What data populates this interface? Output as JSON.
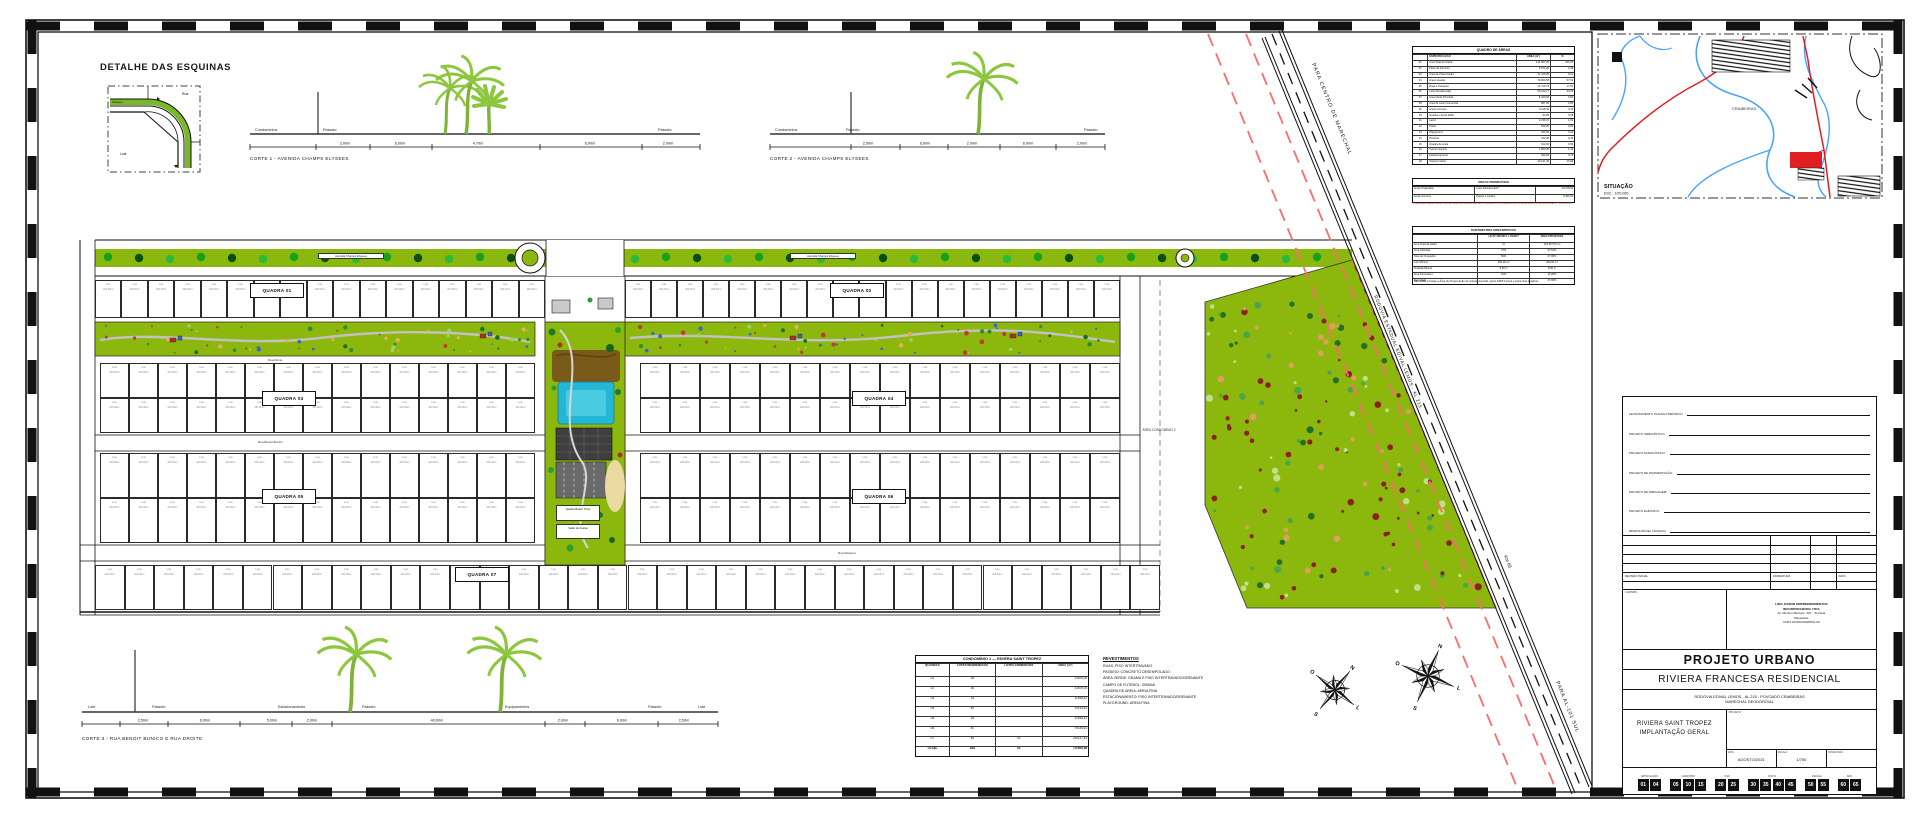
{
  "corner_detail": {
    "title": "DETALHE DAS ESQUINAS",
    "rua": "Rua",
    "passeio": "Passeio",
    "lote": "Lote",
    "dim1": "3,00",
    "dim2": "3,00"
  },
  "cortes": [
    {
      "caption": "CORTE 1 - AVENIDA CHAMPS ELYSEES",
      "labels": [
        "Condomínios",
        "Passeio",
        "Passeio"
      ],
      "dims": [
        "2,00m",
        "6,00m",
        "4,70m",
        "6,00m",
        "2,00m"
      ]
    },
    {
      "caption": "CORTE 2 - AVENIDA CHAMPS ELYSEES",
      "labels": [
        "Condomínios",
        "Passeio",
        "Passeio"
      ],
      "dims": [
        "2,50m",
        "6,00m",
        "2,00m",
        "6,00m",
        "2,00m"
      ]
    },
    {
      "caption": "CORTE 3 - RUA BENOIT BUNICO E RUA DROITE",
      "labels": [
        "Lote",
        "Passeio",
        "Estacionamento",
        "Passeio",
        "Equipamentos",
        "Passeio",
        "Lote"
      ],
      "dims": [
        "2,50m",
        "6,00m",
        "5,00m",
        "2,00m",
        "40,00m",
        "2,00m",
        "6,00m",
        "2,50m"
      ]
    }
  ],
  "plan": {
    "avenue_label": "Avenida Champs Elysees",
    "street_droite": "Rua Droite",
    "street_benoit": "Rua Benoit Bunico",
    "street_messina": "Rua Messina",
    "quadras": [
      "QUADRA 01",
      "QUADRA 02",
      "QUADRA 03",
      "QUADRA 04",
      "QUADRA 05",
      "QUADRA 06",
      "QUADRA 07"
    ],
    "area2_label": "ÁREA CONDOMÍNIO 2",
    "lot_label": "Lote",
    "lot_area": "200,00m²",
    "central_labels": [
      "Quadra Beach Tênis",
      "Salão de Festas"
    ],
    "road": {
      "name": "RODOVIA ESTADUAL EDIVAL LEMOS - AL 215",
      "km": "Km 65",
      "to_north": "PARA CENTRO DE MARECHAL",
      "to_south": "PARA AL-101 SUL"
    }
  },
  "quadro_areas": {
    "title": "QUADRO DE ÁREAS",
    "columns": [
      "",
      "ESPECIFICAÇÃO",
      "ÁREA (m²)",
      "%"
    ],
    "rows": [
      [
        "01",
        "Área Total da Gleba",
        "123.367,00",
        "100,00"
      ],
      [
        "02",
        "Faixa de Domínio",
        "3.071,20",
        "2,49"
      ],
      [
        "03",
        "Área de Preservação",
        "11.116,05",
        "9,01"
      ],
      [
        "04",
        "Área Loteada",
        "70.960,58",
        "57,52"
      ],
      [
        "05",
        "Ruas e Passeios",
        "21.710,75",
        "17,60"
      ],
      [
        "06",
        "Lotes Residenciais",
        "50.122,77",
        "40,63"
      ],
      [
        "07",
        "Área Verde Principal",
        "8.420,00",
        "6,82"
      ],
      [
        "08",
        "Área de Lazer Comercial",
        "987,00",
        "0,80"
      ],
      [
        "09",
        "Áreas Comuns",
        "5.118,42",
        "4,15"
      ],
      [
        "10",
        "Guarita e Apoio ADM",
        "94,05",
        "0,08"
      ],
      [
        "11",
        "Lazer",
        "2.236,70",
        "1,81"
      ],
      [
        "12",
        "Clube",
        "812,00",
        "0,66"
      ],
      [
        "13",
        "Playground",
        "420,00",
        "0,34"
      ],
      [
        "14",
        "Piscinas",
        "312,00",
        "0,25"
      ],
      [
        "15",
        "Quadra de Areia",
        "612,00",
        "0,50"
      ],
      [
        "16",
        "Campo Society",
        "1.800,00",
        "1,46"
      ],
      [
        "17",
        "Estacionamento",
        "940,00",
        "0,76"
      ],
      [
        "18",
        "Sistema Viário",
        "13.191,49",
        "10,69"
      ]
    ]
  },
  "permeaveis": {
    "title": "ÁREAS PERMEÁVEIS",
    "rows": [
      [
        "Áreas Projetadas",
        "Lotes Residenciais*",
        "44.278,00"
      ],
      [
        "Áreas Comuns",
        "Praças e Jardins",
        "8.420,00"
      ]
    ],
    "note": "* A área permeável específica de cada lote deverá atender o disposto no Zoneamento e Ordenamento de Lei Municipal N° 1.028/2017."
  },
  "parametros": {
    "title": "PARÂMETROS URBANÍSTICOS",
    "columns": [
      "",
      "LEI Nº 295/2017 e 10/2017",
      "ÁREA PROJETADA"
    ],
    "rows": [
      [
        "Área Total da Gleba",
        "m²",
        "123.367,00 m²"
      ],
      [
        "Área Utilizada",
        "70%",
        "57,52%"
      ],
      [
        "Taxa de Ocupação",
        "60%",
        "47,00%"
      ],
      [
        "Lote Mínimo",
        "200,00 m²",
        "200,00 m²"
      ],
      [
        "Testada Mínima",
        "8,00 m",
        "8,00 m"
      ],
      [
        "Área Permeável",
        "10%",
        "11,05%"
      ],
      [
        "Densidade",
        "—",
        "47,00%"
      ]
    ],
    "note": "* Não estão inclusas a Área de Preservação de Coleta, Avenida, Apoio ADM, Lixeira e Apoio das Quadras."
  },
  "condominio_table": {
    "title": "CONDOMÍNIO 1 — RIVIERA SAINT TROPEZ",
    "columns": [
      "QUADRAS",
      "LOTES RESIDENCIAIS",
      "LOTES COMERCIAIS",
      "ÁREA (m²)"
    ],
    "rows": [
      [
        "01",
        "30",
        "",
        "4.800,00"
      ],
      [
        "02",
        "30",
        "",
        "4.800,00"
      ],
      [
        "03",
        "34",
        "",
        "6.468,42"
      ],
      [
        "04",
        "40",
        "",
        "9.634,61"
      ],
      [
        "05",
        "34",
        "",
        "6.468,42"
      ],
      [
        "06",
        "40",
        "",
        "9.634,61"
      ],
      [
        "07",
        "45",
        "01",
        "26.637,81"
      ],
      [
        "TOTAL",
        "253",
        "01",
        "70.960,58"
      ]
    ]
  },
  "notes": {
    "title": "REVESTIMENTOS",
    "lines": [
      "RUAS: PISO INTERTRAVADO",
      "PASSEIO: CONCRETO DESEMPOLADO",
      "ÁREA VERDE: GRAMA E PISO INTERTRAVADO/DRENANTE",
      "CAMPO DE FUTEBOL: GRAMA",
      "QUADRA DE AREIA: AREIA FINA",
      "ESTACIONAMENTO: PISO INTERTRAVADO/DRENANTE",
      "PLAYGROUND: AREIA FINA"
    ]
  },
  "map": {
    "caption": "SITUAÇÃO",
    "scale": "ESC.: 1/20.000",
    "place": "CRAIBEIRAS"
  },
  "compass": {
    "letters": [
      "N",
      "L",
      "S",
      "O"
    ]
  },
  "title_block": {
    "signature_rows": [
      "LEVANTAMENTO PLANIALTIMÉTRICO:",
      "PROJETO URBANÍSTICO:",
      "PROJETO PAISAGÍSTICO:",
      "PROJETO DE PAVIMENTAÇÃO:",
      "PROJETO DE DRENAGEM:",
      "PROJETO ELÉTRICO:",
      "RESPONSÁVEL TÉCNICO:"
    ],
    "revision_labels": [
      "REVISÃO INICIAL",
      "ASSINATURA",
      "DATA"
    ],
    "stamp_label": "CARIMBO",
    "company_lines": [
      "LIMA JUNIOR EMPREENDIMENTOS",
      "INCORPORADORA LTDA",
      "Av. Menino Marcelo, 307 - Serraria",
      "Maceió/AL",
      "CNPJ 00.000.000/0001-00"
    ],
    "type": "PROJETO URBANO",
    "name": "RIVIERA FRANCESA RESIDENCIAL",
    "address1": "RODOVIA EDIVAL LEMOS - AL 215 - POVOADO CRAIBEIRAS",
    "address2": "MARECHAL DEODORO/AL",
    "drawing1": "RIVIERA SAINT TROPEZ",
    "drawing2": "IMPLANTAÇÃO GERAL",
    "proj_label": "PROJETO:",
    "fields": [
      {
        "label": "DATA",
        "value": "AGOSTO/2021"
      },
      {
        "label": "ESCALA",
        "value": "1/750"
      },
      {
        "label": "ASSINATURA",
        "value": ""
      }
    ],
    "sheet_boxes": {
      "group_labels": [
        "ARTICULAÇÃO",
        "CADASTRO",
        "USO",
        "FOLHA",
        "ESCALA",
        "ANO"
      ],
      "groups": [
        [
          "01",
          "04"
        ],
        [
          "05",
          "10",
          "15"
        ],
        [
          "20",
          "25"
        ],
        [
          "30",
          "35",
          "40",
          "45"
        ],
        [
          "50",
          "55"
        ],
        [
          "60",
          "65"
        ]
      ]
    }
  }
}
